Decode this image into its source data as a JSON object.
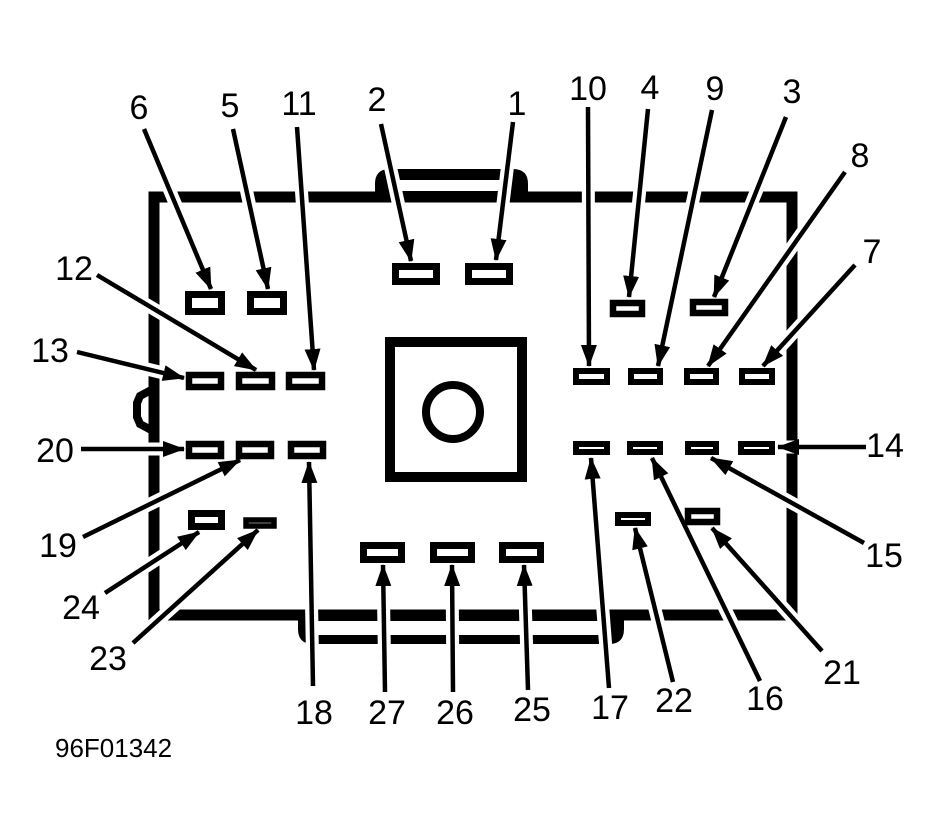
{
  "figure": {
    "code": "96F01342",
    "line_color": "#000000",
    "background_color": "#ffffff",
    "callout_count": 27
  },
  "callouts": {
    "c1": {
      "label": "1"
    },
    "c2": {
      "label": "2"
    },
    "c3": {
      "label": "3"
    },
    "c4": {
      "label": "4"
    },
    "c5": {
      "label": "5"
    },
    "c6": {
      "label": "6"
    },
    "c7": {
      "label": "7"
    },
    "c8": {
      "label": "8"
    },
    "c9": {
      "label": "9"
    },
    "c10": {
      "label": "10"
    },
    "c11": {
      "label": "11"
    },
    "c12": {
      "label": "12"
    },
    "c13": {
      "label": "13"
    },
    "c14": {
      "label": "14"
    },
    "c15": {
      "label": "15"
    },
    "c16": {
      "label": "16"
    },
    "c17": {
      "label": "17"
    },
    "c18": {
      "label": "18"
    },
    "c19": {
      "label": "19"
    },
    "c20": {
      "label": "20"
    },
    "c21": {
      "label": "21"
    },
    "c22": {
      "label": "22"
    },
    "c23": {
      "label": "23"
    },
    "c24": {
      "label": "24"
    },
    "c25": {
      "label": "25"
    },
    "c26": {
      "label": "26"
    },
    "c27": {
      "label": "27"
    }
  }
}
